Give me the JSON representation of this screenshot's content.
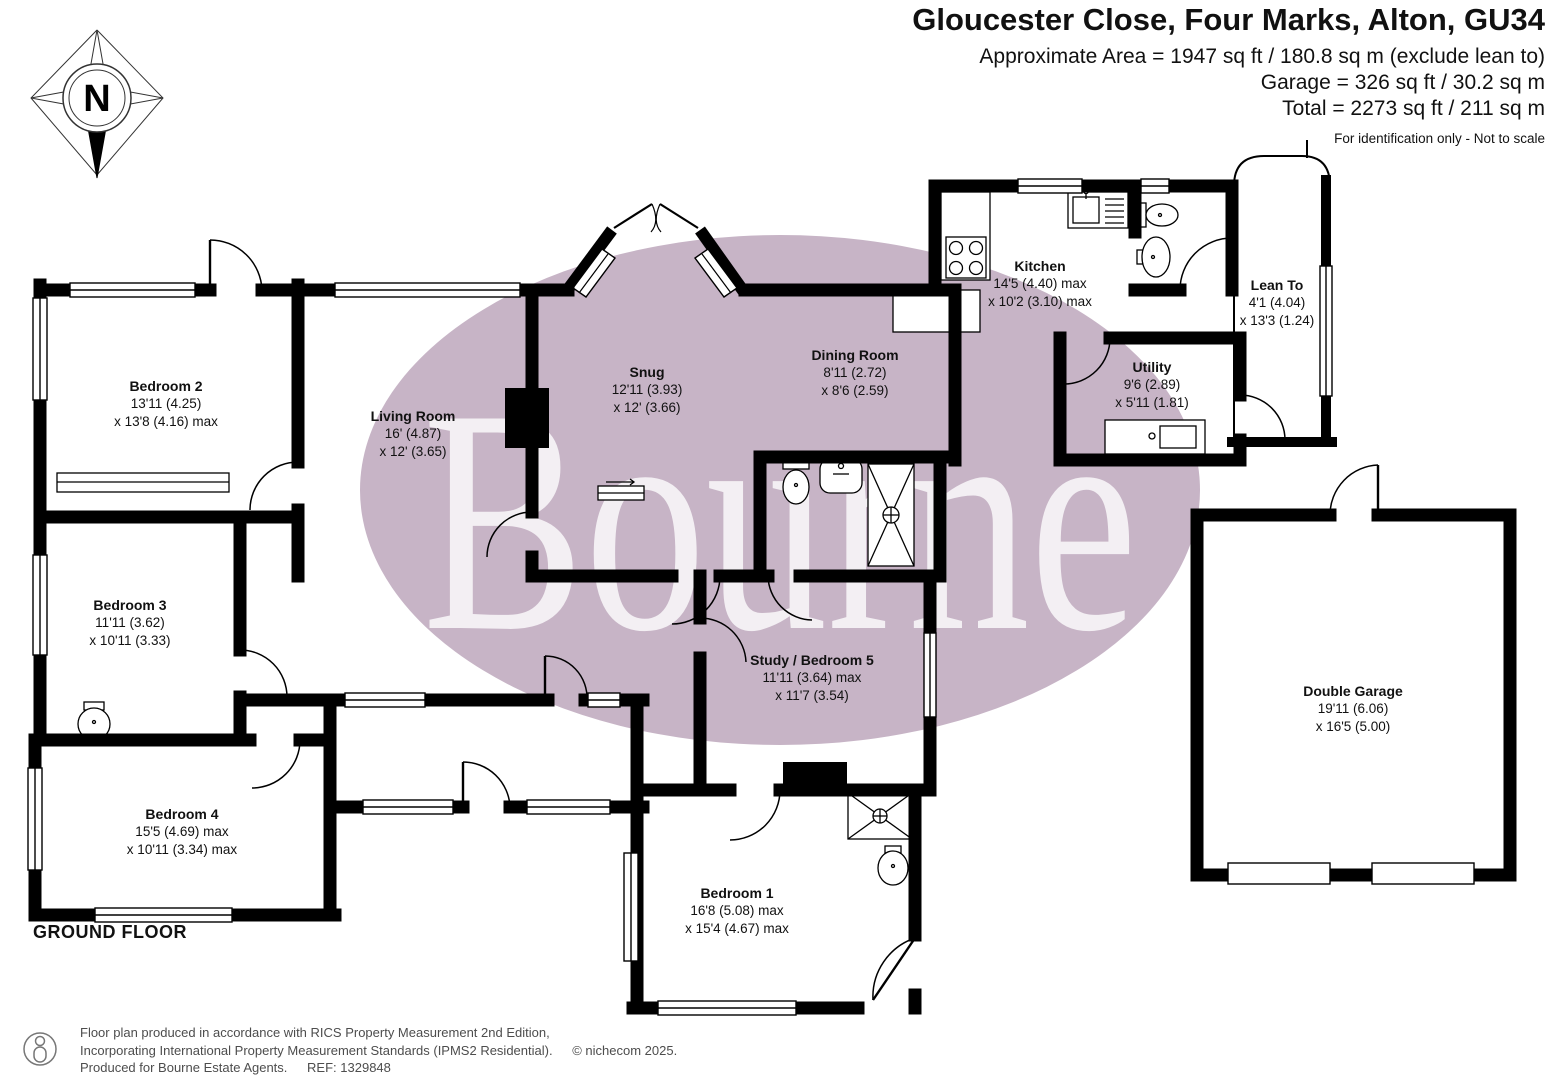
{
  "header": {
    "title": "Gloucester Close, Four Marks, Alton, GU34",
    "area_line1": "Approximate Area = 1947 sq ft / 180.8 sq m (exclude lean to)",
    "area_line2": "Garage = 326 sq ft / 30.2 sq m",
    "area_line3": "Total = 2273 sq ft / 211 sq m",
    "disclaimer": "For identification only - Not to scale"
  },
  "compass": {
    "label": "N"
  },
  "floor_label": "GROUND FLOOR",
  "watermark": {
    "text": "Bourne",
    "ellipse_color": "#c7b4c6",
    "text_color": "#ffffff"
  },
  "colors": {
    "wall": "#000000",
    "background": "#ffffff",
    "footer_text": "#4d4d4d"
  },
  "rooms": [
    {
      "name": "Bedroom 2",
      "dim1": "13'11 (4.25)",
      "dim2": "x 13'8 (4.16) max"
    },
    {
      "name": "Living Room",
      "dim1": "16' (4.87)",
      "dim2": "x 12' (3.65)"
    },
    {
      "name": "Snug",
      "dim1": "12'11 (3.93)",
      "dim2": "x 12' (3.66)"
    },
    {
      "name": "Dining Room",
      "dim1": "8'11 (2.72)",
      "dim2": "x 8'6 (2.59)"
    },
    {
      "name": "Kitchen",
      "dim1": "14'5 (4.40) max",
      "dim2": "x 10'2 (3.10) max"
    },
    {
      "name": "Lean To",
      "dim1": "4'1 (4.04)",
      "dim2": "x 13'3 (1.24)"
    },
    {
      "name": "Utility",
      "dim1": "9'6 (2.89)",
      "dim2": "x 5'11 (1.81)"
    },
    {
      "name": "Bedroom 3",
      "dim1": "11'11 (3.62)",
      "dim2": "x 10'11 (3.33)"
    },
    {
      "name": "Study / Bedroom 5",
      "dim1": "11'11 (3.64) max",
      "dim2": "x 11'7 (3.54)"
    },
    {
      "name": "Bedroom 4",
      "dim1": "15'5 (4.69) max",
      "dim2": "x 10'11 (3.34) max"
    },
    {
      "name": "Bedroom 1",
      "dim1": "16'8 (5.08) max",
      "dim2": "x 15'4 (4.67) max"
    },
    {
      "name": "Double Garage",
      "dim1": "19'11 (6.06)",
      "dim2": "x 16'5 (5.00)"
    }
  ],
  "footer": {
    "line1": "Floor plan produced in accordance with RICS Property Measurement 2nd Edition,",
    "line2": "Incorporating International Property Measurement Standards (IPMS2 Residential).",
    "copyright": "© nichecom 2025.",
    "line3": "Produced for Bourne Estate Agents.",
    "ref": "REF: 1329848"
  }
}
